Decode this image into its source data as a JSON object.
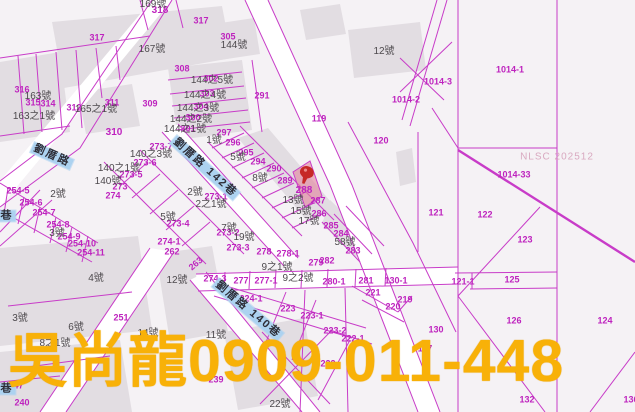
{
  "map": {
    "watermark": "NLSC 202512",
    "overlay_contact": "吳尚龍0909-011-448",
    "colors": {
      "parcel_line": "#C83CC8",
      "parcel_label": "#BE23BE",
      "house_label": "#4D494D",
      "road_label_bg": "#ACD2F0",
      "building_fill": "#E2DDE2",
      "road_fill": "#FFFFFF",
      "background": "#F5F2F5",
      "highlight_parcel_fill": "#E2829D",
      "pin": "#C62828",
      "overlay_text": "#F8B108",
      "watermark": "#D9A9C0"
    },
    "pin": {
      "x": 306,
      "y": 175,
      "parcel": "288"
    },
    "road_labels": [
      {
        "t": "劉厝路",
        "x": 52,
        "y": 156,
        "r": 24
      },
      {
        "t": "劉厝路 142巷",
        "x": 205,
        "y": 168,
        "r": 42
      },
      {
        "t": "劉厝路 140巷",
        "x": 248,
        "y": 310,
        "r": 40
      },
      {
        "t": "巷",
        "x": 7,
        "y": 216,
        "r": 0
      },
      {
        "t": "巷",
        "x": 7,
        "y": 389,
        "r": 0
      }
    ],
    "parcel_labels": [
      {
        "t": "317",
        "x": 97,
        "y": 38
      },
      {
        "t": "317",
        "x": 201,
        "y": 21
      },
      {
        "t": "318",
        "x": 160,
        "y": 11,
        "b": true
      },
      {
        "t": "316",
        "x": 22,
        "y": 90
      },
      {
        "t": "315",
        "x": 33,
        "y": 103
      },
      {
        "t": "314",
        "x": 48,
        "y": 104
      },
      {
        "t": "312",
        "x": 74,
        "y": 108
      },
      {
        "t": "311",
        "x": 112,
        "y": 103
      },
      {
        "t": "309",
        "x": 150,
        "y": 104
      },
      {
        "t": "310",
        "x": 114,
        "y": 133,
        "b": true
      },
      {
        "t": "308",
        "x": 182,
        "y": 69
      },
      {
        "t": "305",
        "x": 228,
        "y": 37
      },
      {
        "t": "302",
        "x": 211,
        "y": 79
      },
      {
        "t": "303",
        "x": 207,
        "y": 94
      },
      {
        "t": "304",
        "x": 201,
        "y": 107
      },
      {
        "t": "300",
        "x": 193,
        "y": 118
      },
      {
        "t": "301",
        "x": 188,
        "y": 129
      },
      {
        "t": "291",
        "x": 262,
        "y": 96
      },
      {
        "t": "297",
        "x": 224,
        "y": 133
      },
      {
        "t": "296",
        "x": 233,
        "y": 143
      },
      {
        "t": "295",
        "x": 246,
        "y": 153
      },
      {
        "t": "294",
        "x": 258,
        "y": 162
      },
      {
        "t": "290",
        "x": 274,
        "y": 169
      },
      {
        "t": "289",
        "x": 285,
        "y": 181
      },
      {
        "t": "288",
        "x": 304,
        "y": 191,
        "b": true
      },
      {
        "t": "287",
        "x": 318,
        "y": 201
      },
      {
        "t": "286",
        "x": 319,
        "y": 214
      },
      {
        "t": "285",
        "x": 331,
        "y": 226
      },
      {
        "t": "284",
        "x": 341,
        "y": 234
      },
      {
        "t": "283",
        "x": 353,
        "y": 251
      },
      {
        "t": "282",
        "x": 327,
        "y": 261
      },
      {
        "t": "279",
        "x": 316,
        "y": 263
      },
      {
        "t": "278",
        "x": 264,
        "y": 252
      },
      {
        "t": "278-1",
        "x": 288,
        "y": 254
      },
      {
        "t": "277",
        "x": 241,
        "y": 281
      },
      {
        "t": "277-1",
        "x": 266,
        "y": 281
      },
      {
        "t": "280-1",
        "x": 334,
        "y": 282
      },
      {
        "t": "281",
        "x": 366,
        "y": 281
      },
      {
        "t": "130-1",
        "x": 396,
        "y": 281
      },
      {
        "t": "274-3",
        "x": 215,
        "y": 279
      },
      {
        "t": "273",
        "x": 120,
        "y": 187
      },
      {
        "t": "274",
        "x": 113,
        "y": 196
      },
      {
        "t": "273-5",
        "x": 131,
        "y": 175
      },
      {
        "t": "273-6",
        "x": 145,
        "y": 163
      },
      {
        "t": "273-7",
        "x": 161,
        "y": 147
      },
      {
        "t": "273-1",
        "x": 216,
        "y": 197
      },
      {
        "t": "273-2",
        "x": 228,
        "y": 233
      },
      {
        "t": "273-3",
        "x": 238,
        "y": 248
      },
      {
        "t": "273-4",
        "x": 178,
        "y": 224
      },
      {
        "t": "254-5",
        "x": 18,
        "y": 191
      },
      {
        "t": "254-6",
        "x": 31,
        "y": 203
      },
      {
        "t": "254-7",
        "x": 44,
        "y": 213
      },
      {
        "t": "254-8",
        "x": 58,
        "y": 225
      },
      {
        "t": "254-9",
        "x": 69,
        "y": 237
      },
      {
        "t": "254-10",
        "x": 82,
        "y": 244
      },
      {
        "t": "254-11",
        "x": 91,
        "y": 253
      },
      {
        "t": "274-1",
        "x": 169,
        "y": 242
      },
      {
        "t": "262",
        "x": 172,
        "y": 252
      },
      {
        "t": "263",
        "x": 196,
        "y": 264,
        "r": -40
      },
      {
        "t": "251",
        "x": 121,
        "y": 318
      },
      {
        "t": "224-1",
        "x": 251,
        "y": 299
      },
      {
        "t": "223",
        "x": 288,
        "y": 309
      },
      {
        "t": "223-1",
        "x": 312,
        "y": 316
      },
      {
        "t": "223-2",
        "x": 335,
        "y": 331
      },
      {
        "t": "222-1",
        "x": 353,
        "y": 339
      },
      {
        "t": "222",
        "x": 328,
        "y": 364
      },
      {
        "t": "221",
        "x": 373,
        "y": 293
      },
      {
        "t": "220",
        "x": 393,
        "y": 307
      },
      {
        "t": "219",
        "x": 405,
        "y": 300
      },
      {
        "t": "240",
        "x": 22,
        "y": 403
      },
      {
        "t": "247",
        "x": 16,
        "y": 386
      },
      {
        "t": "239",
        "x": 216,
        "y": 380
      },
      {
        "t": "130",
        "x": 436,
        "y": 330
      },
      {
        "t": "117",
        "x": 425,
        "y": 349
      },
      {
        "t": "121-1",
        "x": 463,
        "y": 282
      },
      {
        "t": "125",
        "x": 512,
        "y": 280
      },
      {
        "t": "126",
        "x": 514,
        "y": 321
      },
      {
        "t": "124",
        "x": 605,
        "y": 321
      },
      {
        "t": "123",
        "x": 525,
        "y": 240
      },
      {
        "t": "122",
        "x": 485,
        "y": 215
      },
      {
        "t": "121",
        "x": 436,
        "y": 213
      },
      {
        "t": "120",
        "x": 381,
        "y": 141
      },
      {
        "t": "119",
        "x": 319,
        "y": 119
      },
      {
        "t": "1014-1",
        "x": 510,
        "y": 70
      },
      {
        "t": "1014-3",
        "x": 438,
        "y": 82
      },
      {
        "t": "1014-2",
        "x": 406,
        "y": 100
      },
      {
        "t": "1014-33",
        "x": 514,
        "y": 175
      },
      {
        "t": "132",
        "x": 527,
        "y": 400
      },
      {
        "t": "136",
        "x": 631,
        "y": 400
      }
    ],
    "house_labels": [
      {
        "t": "169號",
        "x": 153,
        "y": 5
      },
      {
        "t": "167號",
        "x": 152,
        "y": 50
      },
      {
        "t": "144號",
        "x": 234,
        "y": 46
      },
      {
        "t": "12號",
        "x": 384,
        "y": 52
      },
      {
        "t": "163號",
        "x": 38,
        "y": 97
      },
      {
        "t": "165之1號",
        "x": 96,
        "y": 110
      },
      {
        "t": "163之1號",
        "x": 34,
        "y": 117
      },
      {
        "t": "144之5號",
        "x": 212,
        "y": 81
      },
      {
        "t": "144之4號",
        "x": 205,
        "y": 96
      },
      {
        "t": "144之3號",
        "x": 198,
        "y": 109
      },
      {
        "t": "144之2號",
        "x": 191,
        "y": 120
      },
      {
        "t": "144之1號",
        "x": 185,
        "y": 130
      },
      {
        "t": "140之3號",
        "x": 151,
        "y": 155
      },
      {
        "t": "140之1號",
        "x": 119,
        "y": 169
      },
      {
        "t": "140號",
        "x": 108,
        "y": 182
      },
      {
        "t": "1號",
        "x": 214,
        "y": 141
      },
      {
        "t": "5號",
        "x": 238,
        "y": 158
      },
      {
        "t": "8號",
        "x": 260,
        "y": 179
      },
      {
        "t": "2號",
        "x": 58,
        "y": 195
      },
      {
        "t": "2號",
        "x": 195,
        "y": 193
      },
      {
        "t": "2之1號",
        "x": 211,
        "y": 205
      },
      {
        "t": "5號",
        "x": 168,
        "y": 218
      },
      {
        "t": "3號",
        "x": 57,
        "y": 234
      },
      {
        "t": "7號",
        "x": 229,
        "y": 229
      },
      {
        "t": "19號",
        "x": 244,
        "y": 238
      },
      {
        "t": "13號",
        "x": 293,
        "y": 201
      },
      {
        "t": "15號",
        "x": 301,
        "y": 212
      },
      {
        "t": "17號",
        "x": 309,
        "y": 222
      },
      {
        "t": "58號",
        "x": 345,
        "y": 243
      },
      {
        "t": "9之1號",
        "x": 277,
        "y": 268
      },
      {
        "t": "9之2號",
        "x": 298,
        "y": 279
      },
      {
        "t": "12號",
        "x": 177,
        "y": 281
      },
      {
        "t": "4號",
        "x": 96,
        "y": 279
      },
      {
        "t": "3號",
        "x": 20,
        "y": 319
      },
      {
        "t": "6號",
        "x": 76,
        "y": 328
      },
      {
        "t": "14號",
        "x": 148,
        "y": 334
      },
      {
        "t": "11號",
        "x": 216,
        "y": 336
      },
      {
        "t": "8之1號",
        "x": 55,
        "y": 344
      },
      {
        "t": "22號",
        "x": 280,
        "y": 405
      }
    ]
  }
}
